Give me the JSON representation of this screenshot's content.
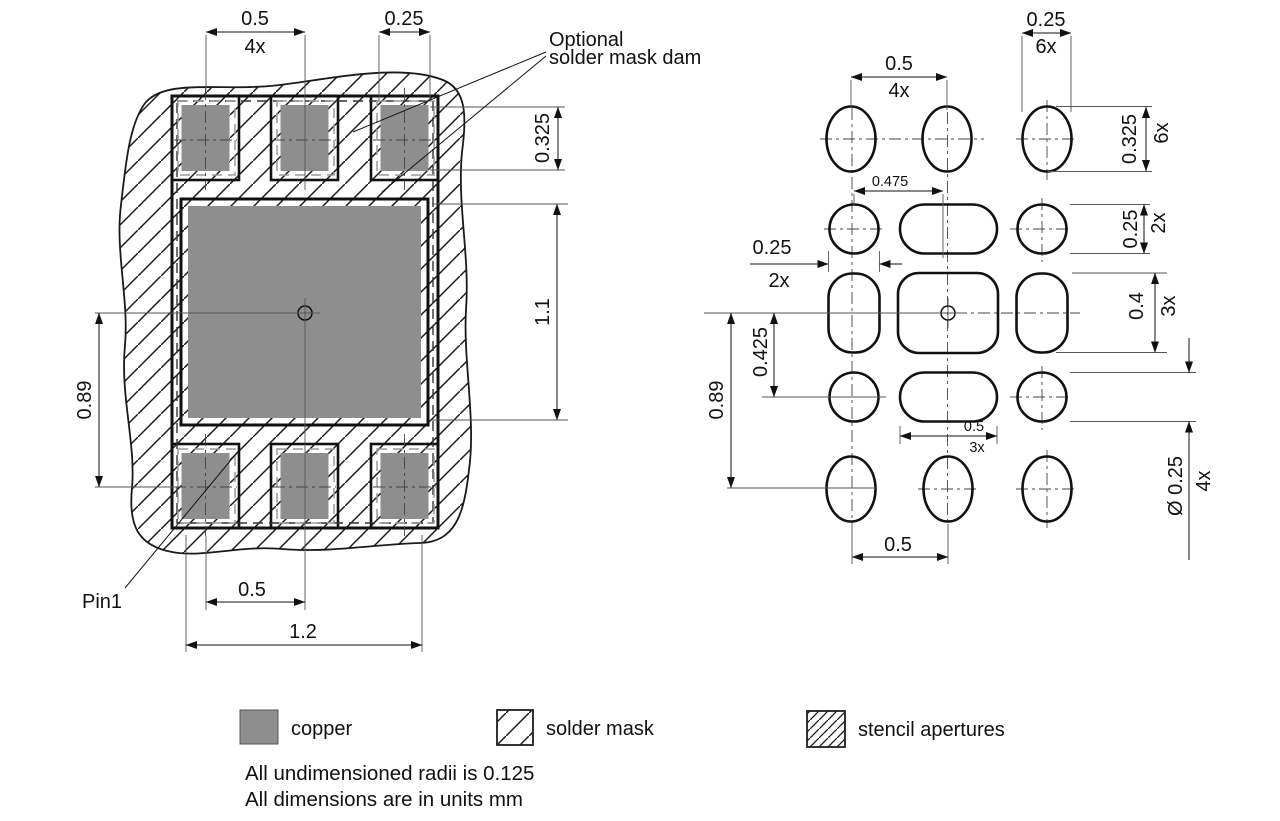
{
  "colors": {
    "copper": "#8e8e8e",
    "line": "#111111",
    "background": "#ffffff"
  },
  "left_figure": {
    "dims": {
      "pitch_top": "0.5",
      "pitch_top_count": "4x",
      "pad_width": "0.25",
      "opening_height": "0.325",
      "center_pad_height": "1.1",
      "row_span": "0.89",
      "pitch_bottom": "0.5",
      "overall_width": "1.2"
    },
    "labels": {
      "dam_line1": "Optional",
      "dam_line2": "solder mask dam",
      "pin1": "Pin1"
    }
  },
  "right_figure": {
    "dims": {
      "pitch_top": "0.5",
      "pitch_top_count": "4x",
      "oval_width": "0.25",
      "oval_width_count": "6x",
      "oval_height": "0.325",
      "oval_height_count": "6x",
      "center_offset": "0.475",
      "side_width": "0.25",
      "side_width_count": "2x",
      "pill_height": "0.25",
      "pill_height_count": "2x",
      "mid_height": "0.4",
      "mid_height_count": "3x",
      "row_offset": "0.425",
      "row_span": "0.89",
      "pill_width": "0.5",
      "pill_width_count": "3x",
      "pitch_bottom": "0.5",
      "corner_dia": "Ø 0.25",
      "corner_dia_count": "4x"
    }
  },
  "legend": {
    "items": [
      {
        "label": "copper"
      },
      {
        "label": "solder mask"
      },
      {
        "label": "stencil apertures"
      }
    ]
  },
  "notes": {
    "line1": "All undimensioned radii is 0.125",
    "line2": "All dimensions are in units mm"
  }
}
